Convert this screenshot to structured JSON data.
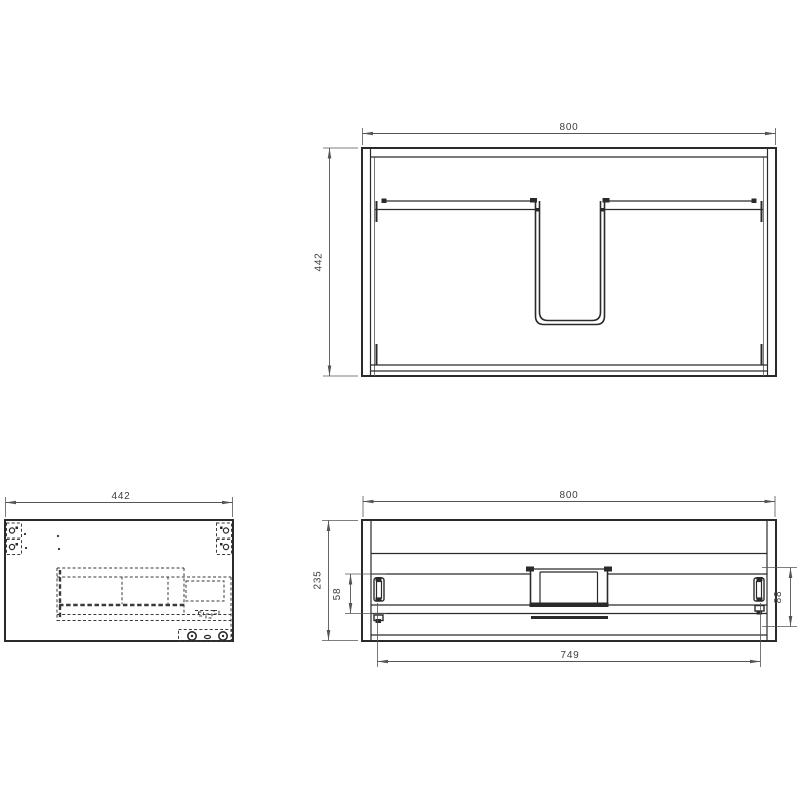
{
  "drawing": {
    "views": {
      "top": {
        "dims": {
          "width": "800",
          "depth": "442"
        }
      },
      "side": {
        "dims": {
          "depth": "442"
        }
      },
      "front": {
        "dims": {
          "width": "800",
          "height": "235",
          "slide_offset": "58",
          "rail_height": "88",
          "opening_width": "749"
        }
      }
    }
  },
  "colors": {
    "background": "#ffffff",
    "object_line": "#2a2a2a",
    "hidden_line": "#3a3a3a",
    "dimension_line": "#555555",
    "dimension_text": "#3d3d3d"
  }
}
